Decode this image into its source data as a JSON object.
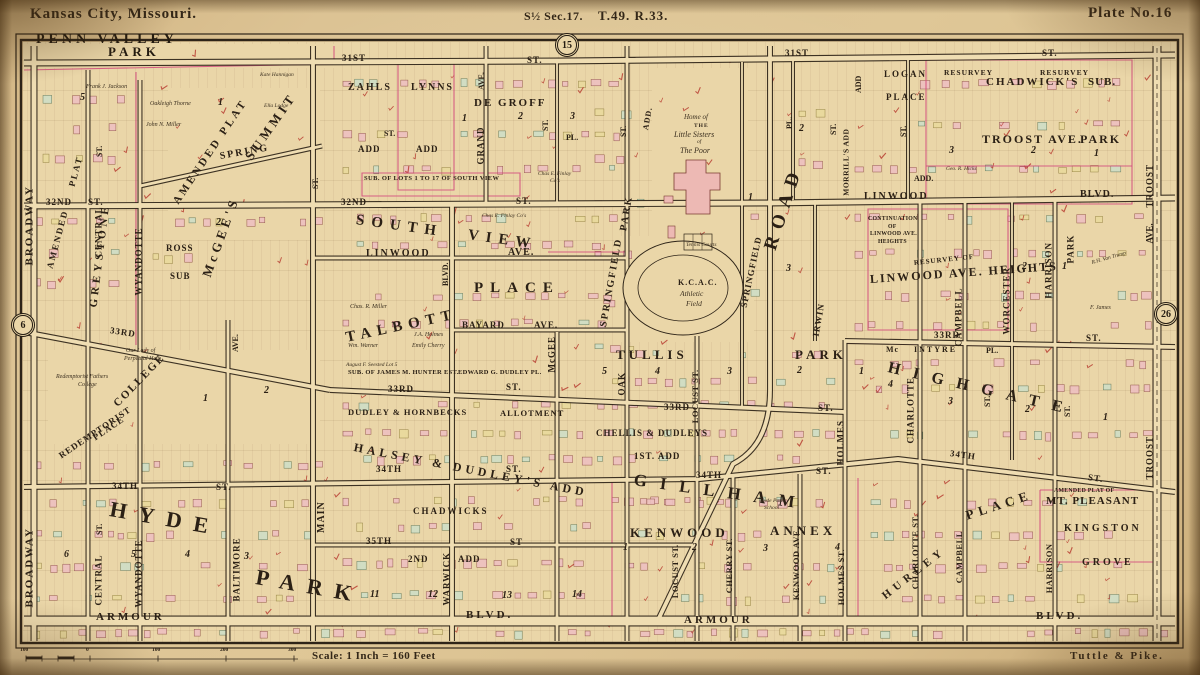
{
  "header": {
    "city": "Kansas City, Missouri.",
    "section": "S½ Sec.17.",
    "township_range": "T.49. R.33.",
    "plate": "Plate No.16"
  },
  "footer": {
    "scale_label": "Scale: 1 Inch = 160 Feet",
    "credit": "Tuttle & Pike.",
    "ruler_ticks": [
      "100",
      "0",
      "100",
      "200",
      "300"
    ]
  },
  "plate_refs": {
    "top": "15",
    "west": "6",
    "east": "26"
  },
  "labels": {
    "penn1": "PENN VALLEY",
    "penn2": "PARK",
    "s31a": "31ST",
    "s31a2": "ST.",
    "s31b": "31ST",
    "s31b2": "ST.",
    "bwyn": "BROADWAY",
    "bwys": "BROADWAY",
    "censtn": "ST.",
    "cenn": "CENTRAL",
    "cens": "CENTRAL",
    "censts": "ST.",
    "wyan": "WYANDOTTE",
    "wyas": "WYANDOTTE",
    "s32a": "32ND",
    "s32a2": "ST.",
    "spring": "SPRING",
    "amplat": "AMENDED PLAT",
    "am2": "AMENDED",
    "plat2": "PLAT",
    "greyst": "GREYSTONE",
    "mcgees": "McGEE'S",
    "summit": "SUMMIT",
    "ross": "ROSS",
    "rosss": "SUB",
    "s33rd": "33RD",
    "lady1": "Our Lady of",
    "lady2": "Perpetual Help",
    "redc1": "Redemptorist Fathers",
    "redc2": "College",
    "college": "COLLEGE",
    "redemp": "REDEMPTORIST",
    "redpl": "PLACE",
    "s34a": "34TH",
    "s34a2": "ST.",
    "hyde": "HYDE",
    "parkbig": "PARK",
    "aveb": "AVE.",
    "balt": "BALTIMORE",
    "main": "MAIN",
    "mainst": "ST.",
    "arm1": "ARMOUR",
    "blvd1": "BLVD.",
    "arm2": "ARMOUR",
    "blvd2": "BLVD.",
    "zahls": "ZAHLS",
    "lynns": "LYNNS",
    "adda": "ADD",
    "addb": "ADD",
    "stsm1": "ST.",
    "degroff": "DE GROFF",
    "grave": "AVE.",
    "grand": "GRAND",
    "dg1": "1",
    "dg2": "2",
    "dg3": "3",
    "dgpl": "PL.",
    "dgst": "ST.",
    "sublots": "SUB. OF LOTS 1 TO 17 OF SOUTH VIEW",
    "fin1a": "Chas E. Finlay",
    "fin1b": "Co's",
    "fin2": "Chas E. Finlay Co's",
    "s32c": "32ND",
    "s32c2": "ST.",
    "south": "SOUTH",
    "view": "VIEW",
    "linav1": "LINWOOD",
    "linav2": "AVE.",
    "talbott": "TALBOTT",
    "tplace": "PLACE",
    "gblvd": "BLVD.",
    "bayard": "BAYARD",
    "bayard2": "AVE.",
    "mcgeev": "McGEE",
    "hunter": "SUB. OF JAMES M. HUNTER EST.",
    "dudpl": "EDWARD G. DUDLEY PL.",
    "miller": "Chas. R. Miller",
    "warner": "Wm. Warner",
    "jholmes": "J.A. Holmes",
    "echerry": "Emily Cherry",
    "seested": "August F. Seested Lot 5",
    "s33c": "33RD",
    "s33c2": "ST.",
    "dudhorn": "DUDLEY & HORNBECKS",
    "allot": "ALLOTMENT",
    "halsey": "HALSEY & DUDLEY'S ADD",
    "s34c": "34TH",
    "s34c2": "ST.",
    "chadw": "CHADWICKS",
    "s35": "35TH",
    "s35b": "ST",
    "add2a": "2ND",
    "add2b": "ADD",
    "warwick": "WARWICK",
    "b11": "11",
    "b12": "12",
    "b13": "13",
    "b14": "14",
    "spkv": "SPRINGFIELD",
    "parkv": "PARK",
    "addv": "ADD.",
    "stoak": "ST.",
    "home1": "Home of",
    "home2": "THE",
    "home3": "Little Sisters",
    "home4": "of",
    "home5": "The Poor",
    "tennis": "Tennis Courts",
    "kcac1": "K.C.A.C.",
    "kcac2": "Athletic",
    "kcac3": "Field",
    "spfst": "SPRINGFIELD",
    "roadbig": "ROAD",
    "plv": "PL.",
    "irwin": "IRWIN",
    "stv1": "ST.",
    "oak": "OAK",
    "tullis": "TULLIS",
    "tullisp": "PARK",
    "t5": "5",
    "t4": "4",
    "t3": "3",
    "t2": "2",
    "t1": "1",
    "locustn": "LOCUST ST.",
    "s33d": "33RD",
    "s33d2": "ST.",
    "chellis": "CHELLIS & DUDLEYS",
    "add1st": "1ST. ADD",
    "gillham": "GILLHAM",
    "holmesn": "HOLMES",
    "s34d": "34TH",
    "s34d2": "ST.",
    "sch1": "Hyde Park",
    "sch2": "School",
    "kenwood": "KENWOOD",
    "annex": "ANNEX",
    "k1": "1",
    "k2": "2",
    "k3": "3",
    "k4": "4",
    "locusts": "LOCUST ST.",
    "cherrys": "CHERRY ST.",
    "kenwv": "KENWOOD AVE.",
    "holmess": "HOLMES ST.",
    "morrills": "MORRILL'S ADD",
    "addv2": "ADD",
    "logan": "LOGAN",
    "loganpl": "PLACE",
    "resur1": "RESURVEY",
    "chsub1": "CHADWICK'S",
    "resur2": "RESURVEY",
    "chsub2": "SUB.",
    "stv2": "ST.",
    "tap1": "TROOST AVE.",
    "tap2": "PARK",
    "tp3": "3",
    "tp2": "2",
    "tp1": "1",
    "addsm": "ADD.",
    "hicks": "Geo. R. Hicks",
    "linb1": "LINWOOD",
    "linb2": "BLVD.",
    "cont1": "CONTINUATION",
    "cont2": "OF",
    "cont3": "LINWOOD AVE.",
    "cont4": "HEIGHTS",
    "resurof": "RESURVEY OF",
    "linhts": "LINWOOD AVE. HEIGHTS",
    "lh2": "2",
    "lh1": "1",
    "charlhg": "CHARLOTTE",
    "campn": "CAMPBELL",
    "worc": "WORCESTER",
    "harrn": "HARRISON",
    "parkv2": "PARK",
    "mcint1": "Mc",
    "mcint2": "INTYRE",
    "mcpl": "PL.",
    "fjames": "F. James",
    "vantr": "R.H. Van Trump",
    "s33e": "33RD",
    "s33e2": "ST.",
    "highgate": "HIGHGATE",
    "stv3": "ST.",
    "stv4": "ST.",
    "s34e": "34TH",
    "s34e2": "ST.",
    "hurley": "HURLEY",
    "placebr": "PLACE",
    "charls": "CHARLOTTE ST.",
    "camps": "CAMPBELL",
    "harrs": "HARRISON",
    "amdmt": "AMENDED PLAT OF",
    "mtpl": "MT. PLEASANT",
    "kingston": "KINGSTON",
    "grove": "GROVE",
    "troostn": "TROOST",
    "troostav": "AVE.",
    "troosts": "TROOST",
    "b5": "5",
    "amp1": "1",
    "amp2": "2",
    "jackson": "Frank J. Jackson",
    "thorne": "Oakleigh Thorne",
    "jmiller": "John N. Miller",
    "hannigan": "Kate Hannigan",
    "lodge": "Ella Lodge",
    "hp1": "1",
    "hp2": "2",
    "hp6": "6",
    "hp5": "5",
    "hp4": "4",
    "hp3": "3",
    "g1": "1",
    "g2": "2",
    "g3": "3",
    "hg4": "4",
    "hg3": "3",
    "hg2": "2",
    "hg1": "1"
  }
}
